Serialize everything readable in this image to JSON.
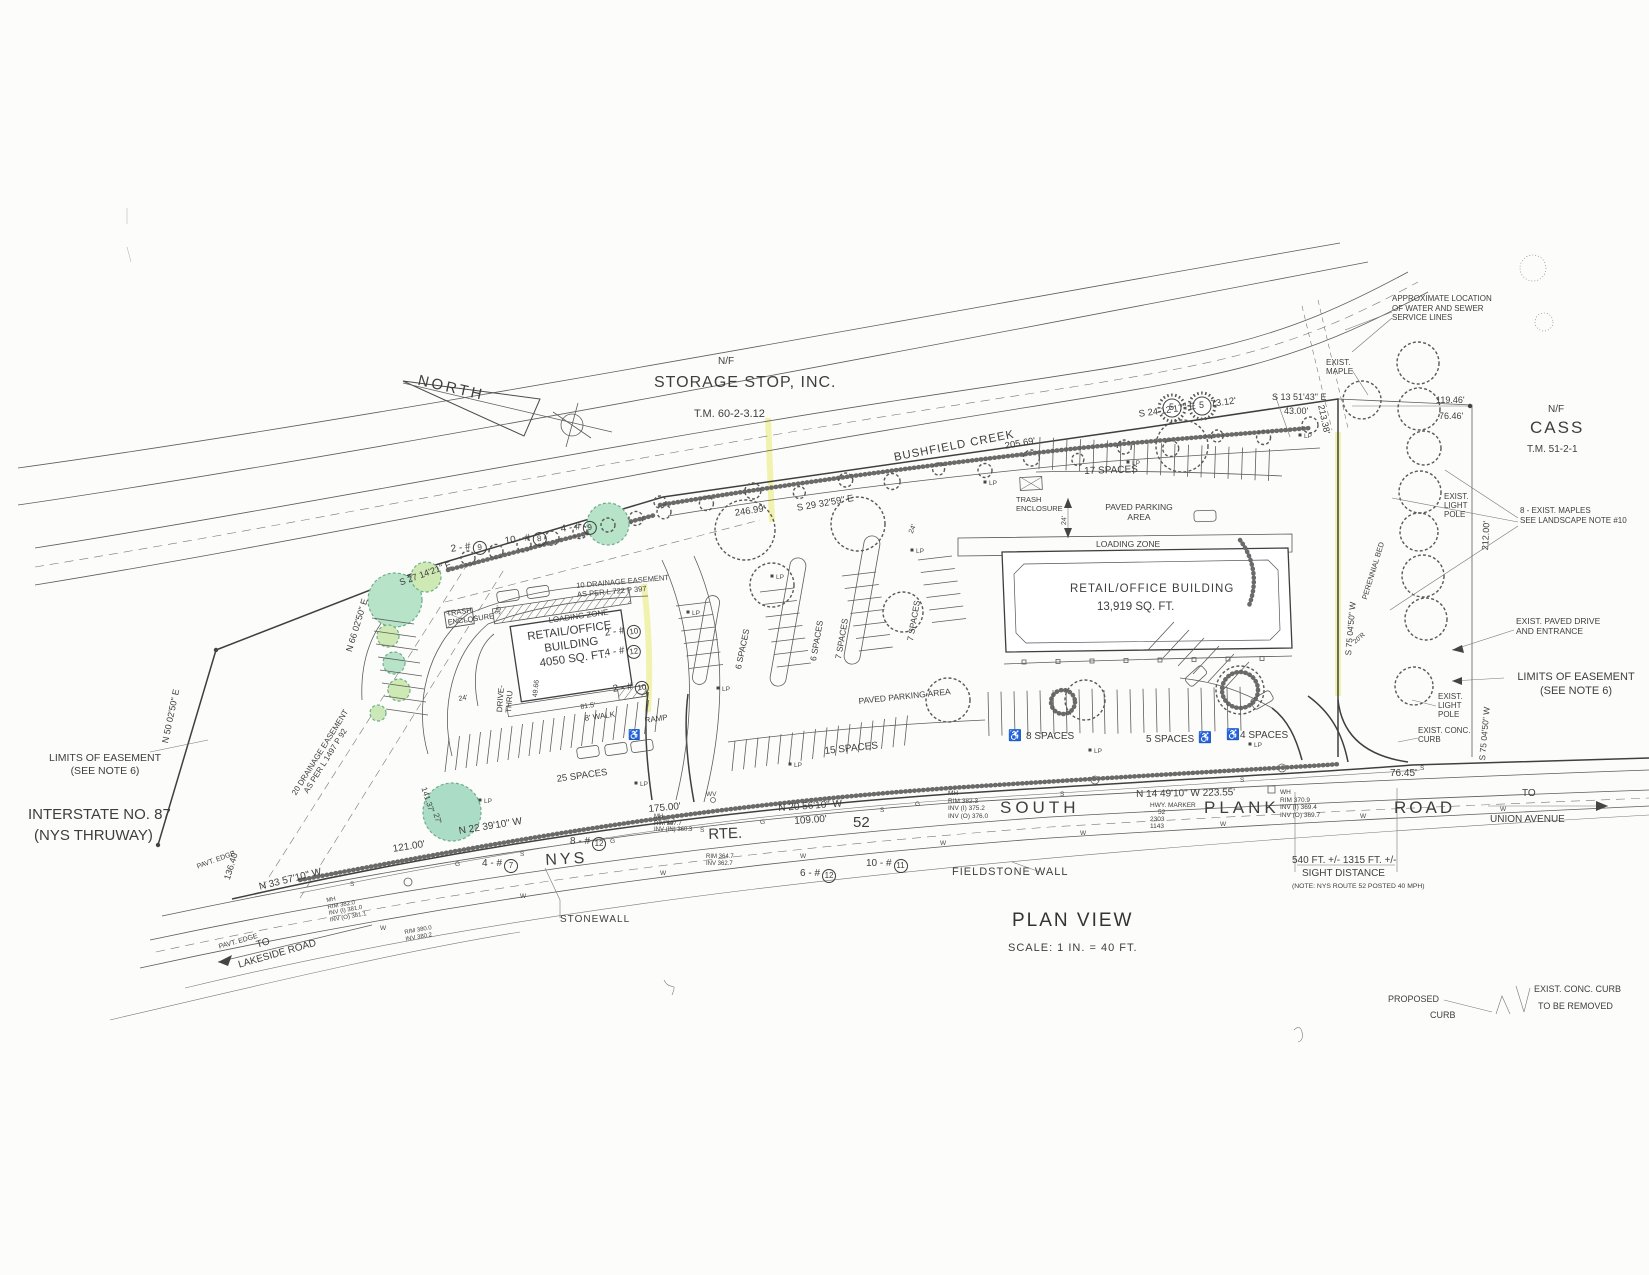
{
  "drawing": {
    "north_label": "NORTH",
    "plan_view": "PLAN VIEW",
    "scale": "SCALE: 1 IN. = 40 FT.",
    "creek": "BUSHFIELD CREEK"
  },
  "parcels": {
    "storage_stop": {
      "nf": "N/F",
      "name": "STORAGE STOP, INC.",
      "tm": "T.M. 60-2-3.12"
    },
    "cass": {
      "nf": "N/F",
      "name": "CASS",
      "tm": "T.M. 51-2-1"
    }
  },
  "buildings": {
    "west": {
      "l1": "RETAIL/OFFICE",
      "l2": "BUILDING",
      "l3": "4050 SQ. FT."
    },
    "east": {
      "l1": "RETAIL/OFFICE BUILDING",
      "l2": "13,919 SQ. FT."
    }
  },
  "roads": {
    "nys": "NYS",
    "rte": "RTE.",
    "num": "52",
    "south": "SOUTH",
    "plank": "PLANK",
    "road": "ROAD",
    "to_a": "TO",
    "union": "UNION AVENUE",
    "to_b": "TO",
    "lakeside": "LAKESIDE ROAD",
    "interstate1": "INTERSTATE NO. 87",
    "interstate2": "(NYS THRUWAY)",
    "pavt_edge": "PAVT. EDGE"
  },
  "bearings": {
    "n50": "N 50 02'50\" E",
    "n66": "N 66 02'50\" E",
    "s27": "S 27 14'21\" E",
    "s29": "S 29 32'59\" E",
    "s24": "S 24 12'17\" E",
    "s13": "S 13 51'43\" E",
    "n33": "N 33 57'10\" W",
    "n22": "N 22 39'10\" W",
    "n20": "N 20 56'10\" W",
    "n14": "N 14 49'10\" W 223.55'",
    "s75": "S 75 04'50\" W"
  },
  "dims": {
    "d136": "136.40'",
    "d121": "121.00'",
    "d175": "175.00'",
    "d109": "109.00'",
    "d246": "246.99'",
    "d205": "205.69'",
    "d73": "73.12'",
    "d43": "43.00'",
    "d213": "213.38'",
    "d119": "119.46'",
    "d76": "76.46'",
    "d212": "212.00'",
    "d7645": "76.45'",
    "d24": "24'",
    "d30": "30'",
    "d4966": "49.66",
    "d815": "81.5'",
    "d20r": "20'R",
    "d141": "141.37'",
    "d27": "27'"
  },
  "site": {
    "loading_zone": "LOADING ZONE",
    "trash1": "TRASH",
    "trash2": "ENCLOSURE",
    "paved_area": "PAVED PARKING AREA",
    "paved_r1": "PAVED PARKING",
    "paved_r2": "AREA",
    "drive1": "DRIVE-",
    "drive2": "THRU",
    "walk": "8' WALK",
    "ramp": "RAMP",
    "fieldstone": "FIELDSTONE WALL",
    "stonewall": "STONEWALL",
    "perennial": "PERENNIAL BED",
    "exist_maple1": "EXIST.",
    "exist_maple2": "MAPLE",
    "lp1": "EXIST.",
    "lp2": "LIGHT",
    "lp3": "POLE",
    "conc1": "EXIST. CONC.",
    "conc2": "CURB",
    "paved_drive1": "EXIST. PAVED DRIVE",
    "paved_drive2": "AND ENTRANCE"
  },
  "parking": {
    "s25": "25 SPACES",
    "s15": "15 SPACES",
    "s17": "17 SPACES",
    "s8": "8 SPACES",
    "s5": "5 SPACES",
    "s4": "4 SPACES",
    "s6": "6 SPACES",
    "s7": "7 SPACES"
  },
  "plants": {
    "c1": {
      "p": "2 - #",
      "n": "9"
    },
    "c2": {
      "p": "10 - #",
      "n": "8"
    },
    "c3": {
      "p": "4 - #",
      "n": "9"
    },
    "c4": {
      "p": "2 - #",
      "n": "10"
    },
    "c5": {
      "p": "4 - #",
      "n": "12"
    },
    "c6": {
      "p": "2 - #",
      "n": "10"
    },
    "c7": {
      "p": "8 - #",
      "n": "12"
    },
    "c8": {
      "p": "4 - #",
      "n": "7"
    },
    "c9": {
      "p": "6 - #",
      "n": "12"
    },
    "c10": {
      "p": "10 - #",
      "n": "11"
    },
    "tag5": "5"
  },
  "notes": {
    "approx1": "APPROXIMATE LOCATION",
    "approx2": "OF WATER AND SEWER",
    "approx3": "SERVICE LINES",
    "maples1": "8 - EXIST. MAPLES",
    "maples2": "SEE LANDSCAPE NOTE #10",
    "limits1": "LIMITS OF EASEMENT",
    "limits2": "(SEE NOTE 6)",
    "sight1": "540 FT. +/-  1315 FT. +/-",
    "sight2": "SIGHT DISTANCE",
    "sight3": "(NOTE: NYS ROUTE 52 POSTED 40 MPH)",
    "dr20a": "20 DRAINAGE EASEMENT",
    "dr20b": "AS PER L 1497 P 92",
    "dr10a": "10 DRAINAGE EASEMENT",
    "dr10b": "AS PER L 722 P 397"
  },
  "legend": {
    "prop1": "PROPOSED",
    "prop2": "CURB",
    "exr1": "EXIST. CONC. CURB",
    "exr2": "TO BE REMOVED"
  },
  "utilities": {
    "mh_a": [
      "MH",
      "RIM 382.0",
      "INV (I) 381.0",
      "INV (O) 381.1"
    ],
    "mh_b": [
      "MH",
      "RIM 367.7",
      "INV (IN) 360.3"
    ],
    "mh_c": [
      "MH",
      "RIM 382.3",
      "INV (I) 375.2",
      "INV (O) 376.0"
    ],
    "wh": [
      "WH",
      "RIM 370.9",
      "INV (I) 369.4",
      "INV (O) 369.7"
    ],
    "rim_a": [
      "RIM 380.0",
      "INV 380.2"
    ],
    "rim_b": [
      "RIM 364.7",
      "INV 362.7"
    ],
    "hwy": [
      "HWY. MARKER",
      "52",
      "2303",
      "1143"
    ]
  },
  "markers": {
    "w": "W",
    "s": "S",
    "g": "G",
    "lp": "LP",
    "wv": "WV",
    "hc": "♿"
  }
}
